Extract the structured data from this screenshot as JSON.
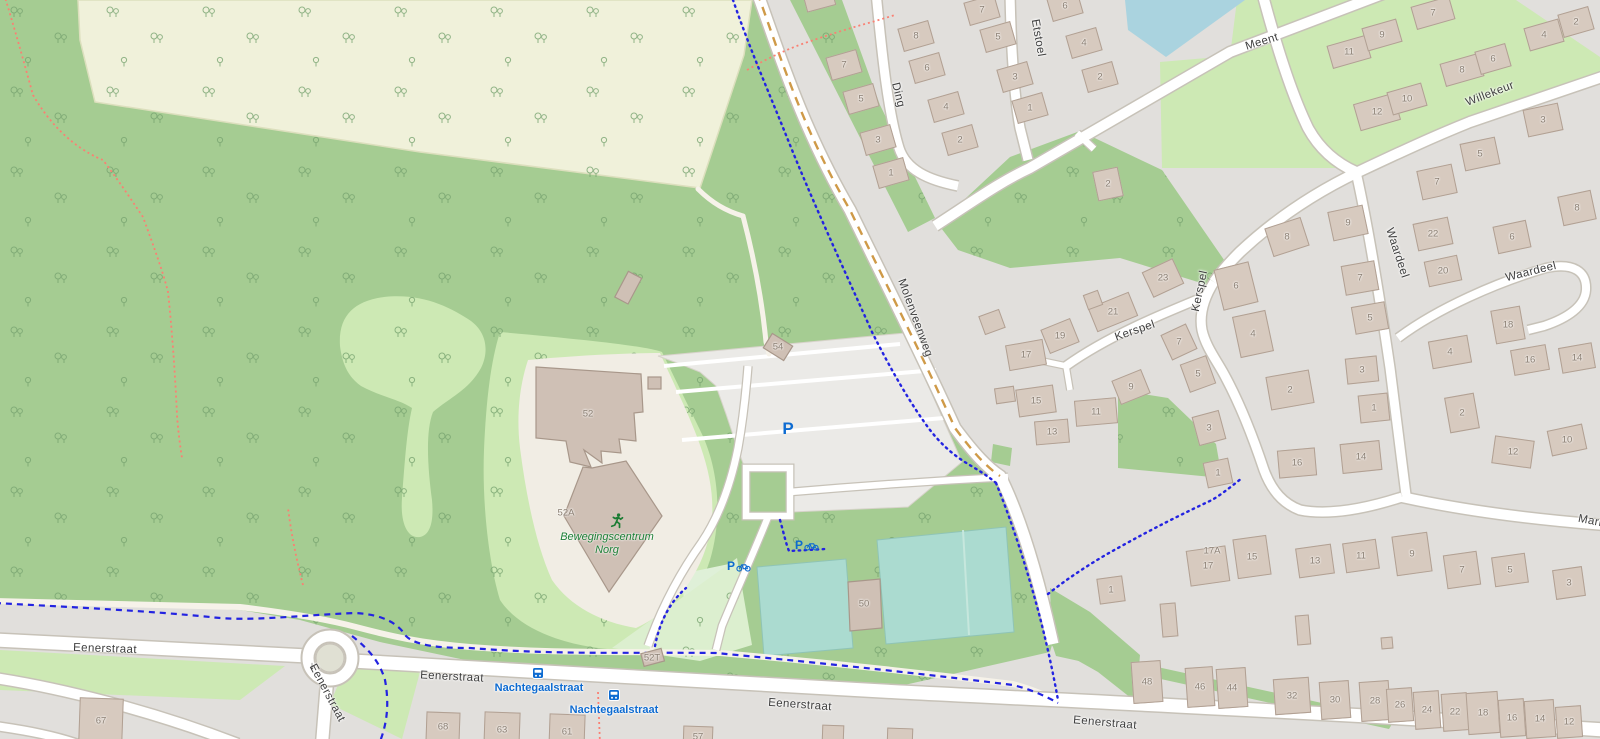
{
  "map": {
    "colors": {
      "residential": "#e1dfdc",
      "forest": "#a5cc92",
      "grass": "#cde9b4",
      "farmland": "#f0f1da",
      "water": "#aad3df",
      "pitch": "#abdbd0",
      "parking": "#ebeae7",
      "building": "#d7cabf",
      "road_fill": "#ffffff",
      "road_casing": "#c7c2b8",
      "cycleway_blue": "#2323e1",
      "footpath_red": "#fa8073",
      "unpaved_dash": "#cf9a48",
      "transit_blue": "#0d6bd1",
      "poi_green": "#1e8038"
    },
    "streets": [
      {
        "text": "Eenerstraat",
        "x": 105,
        "y": 649,
        "rot": 2
      },
      {
        "text": "Eenerstraat",
        "x": 452,
        "y": 677,
        "rot": 3
      },
      {
        "text": "Eenerstraat",
        "x": 327,
        "y": 693,
        "rot": 62
      },
      {
        "text": "Eenerstraat",
        "x": 800,
        "y": 705,
        "rot": 4
      },
      {
        "text": "Eenerstraat",
        "x": 1105,
        "y": 723,
        "rot": 5
      },
      {
        "text": "Molenveenweg",
        "x": 915,
        "y": 318,
        "rot": 70
      },
      {
        "text": "Meent",
        "x": 1262,
        "y": 42,
        "rot": -17
      },
      {
        "text": "Willekeur",
        "x": 1490,
        "y": 94,
        "rot": -21
      },
      {
        "text": "Ding",
        "x": 898,
        "y": 95,
        "rot": 76
      },
      {
        "text": "Etstoel",
        "x": 1038,
        "y": 38,
        "rot": 80
      },
      {
        "text": "Kerspel",
        "x": 1135,
        "y": 331,
        "rot": -19
      },
      {
        "text": "Kerspel",
        "x": 1200,
        "y": 291,
        "rot": -78
      },
      {
        "text": "Waardeel",
        "x": 1397,
        "y": 253,
        "rot": 72
      },
      {
        "text": "Waardeel",
        "x": 1531,
        "y": 272,
        "rot": -14
      },
      {
        "text": "Mari",
        "x": 1590,
        "y": 521,
        "rot": 11
      }
    ],
    "poi": {
      "name_line1": "Bewegingscentrum",
      "name_line2": "Norg",
      "x": 607,
      "y": 531,
      "icon_x": 617,
      "icon_y": 521
    },
    "bus_stops": [
      {
        "name": "Nachtegaalstraat",
        "icon_x": 538,
        "icon_y": 673,
        "label_x": 539,
        "label_y": 688
      },
      {
        "name": "Nachtegaalstraat",
        "icon_x": 614,
        "icon_y": 695,
        "label_x": 614,
        "label_y": 710
      }
    ],
    "parking": [
      {
        "symbol": "P",
        "x": 788,
        "y": 429
      }
    ],
    "bike_parking": [
      {
        "symbol": "P",
        "x": 739,
        "y": 566
      },
      {
        "symbol": "P",
        "x": 807,
        "y": 545
      }
    ],
    "oneway": {
      "symbol": "↓",
      "x": 312,
      "y": 666
    },
    "houses": [
      {
        "t": "7",
        "x": 844,
        "y": 65
      },
      {
        "t": "5",
        "x": 861,
        "y": 99
      },
      {
        "t": "3",
        "x": 878,
        "y": 140
      },
      {
        "t": "1",
        "x": 891,
        "y": 173
      },
      {
        "t": "8",
        "x": 916,
        "y": 36
      },
      {
        "t": "6",
        "x": 927,
        "y": 68
      },
      {
        "t": "4",
        "x": 946,
        "y": 107
      },
      {
        "t": "2",
        "x": 960,
        "y": 140
      },
      {
        "t": "7",
        "x": 982,
        "y": 10
      },
      {
        "t": "5",
        "x": 998,
        "y": 37
      },
      {
        "t": "3",
        "x": 1015,
        "y": 77
      },
      {
        "t": "1",
        "x": 1030,
        "y": 108
      },
      {
        "t": "6",
        "x": 1065,
        "y": 6
      },
      {
        "t": "4",
        "x": 1084,
        "y": 43
      },
      {
        "t": "2",
        "x": 1100,
        "y": 77
      },
      {
        "t": "2",
        "x": 1108,
        "y": 184,
        "w": 26,
        "h": 30,
        "r": -12
      },
      {
        "t": "11",
        "x": 1349,
        "y": 52,
        "w": 40
      },
      {
        "t": "9",
        "x": 1382,
        "y": 35,
        "w": 36
      },
      {
        "t": "7",
        "x": 1433,
        "y": 13,
        "w": 40
      },
      {
        "t": "12",
        "x": 1377,
        "y": 112,
        "w": 42,
        "h": 28
      },
      {
        "t": "10",
        "x": 1407,
        "y": 99,
        "w": 36
      },
      {
        "t": "8",
        "x": 1462,
        "y": 70,
        "w": 40
      },
      {
        "t": "6",
        "x": 1493,
        "y": 59,
        "w": 32
      },
      {
        "t": "4",
        "x": 1544,
        "y": 35,
        "w": 36
      },
      {
        "t": "2",
        "x": 1576,
        "y": 22,
        "w": 32
      },
      {
        "t": "3",
        "x": 1543,
        "y": 120,
        "w": 36,
        "h": 28,
        "r": -12
      },
      {
        "t": "5",
        "x": 1480,
        "y": 154,
        "w": 36,
        "h": 28,
        "r": -12
      },
      {
        "t": "7",
        "x": 1437,
        "y": 182,
        "w": 36,
        "h": 30,
        "r": -12
      },
      {
        "t": "8",
        "x": 1577,
        "y": 208,
        "w": 34,
        "h": 30,
        "r": -12
      },
      {
        "t": "6",
        "x": 1512,
        "y": 237,
        "w": 34,
        "h": 28,
        "r": -12
      },
      {
        "t": "22",
        "x": 1433,
        "y": 234,
        "w": 36,
        "h": 28,
        "r": -12
      },
      {
        "t": "20",
        "x": 1443,
        "y": 271,
        "w": 34,
        "h": 26,
        "r": -12
      },
      {
        "t": "9",
        "x": 1348,
        "y": 223,
        "w": 36,
        "h": 30,
        "r": -12
      },
      {
        "t": "7",
        "x": 1360,
        "y": 278,
        "w": 34,
        "h": 30,
        "r": -10
      },
      {
        "t": "5",
        "x": 1370,
        "y": 318,
        "w": 34,
        "h": 28,
        "r": -10
      },
      {
        "t": "3",
        "x": 1362,
        "y": 370,
        "w": 32,
        "h": 26,
        "r": -6
      },
      {
        "t": "1",
        "x": 1374,
        "y": 408,
        "w": 30,
        "h": 28,
        "r": -6
      },
      {
        "t": "14",
        "x": 1361,
        "y": 457,
        "w": 40,
        "h": 30,
        "r": -6
      },
      {
        "t": "18",
        "x": 1508,
        "y": 325,
        "w": 30,
        "h": 34,
        "r": -10
      },
      {
        "t": "16",
        "x": 1530,
        "y": 360,
        "w": 36,
        "h": 26,
        "r": -10
      },
      {
        "t": "14",
        "x": 1577,
        "y": 358,
        "w": 34,
        "h": 26,
        "r": -10
      },
      {
        "t": "4",
        "x": 1450,
        "y": 352,
        "w": 40,
        "h": 28,
        "r": -10
      },
      {
        "t": "2",
        "x": 1462,
        "y": 413,
        "w": 30,
        "h": 36,
        "r": -10
      },
      {
        "t": "12",
        "x": 1513,
        "y": 452,
        "w": 40,
        "h": 28,
        "r": 8
      },
      {
        "t": "10",
        "x": 1567,
        "y": 440,
        "w": 36,
        "h": 26,
        "r": -12
      },
      {
        "t": "23",
        "x": 1163,
        "y": 278,
        "w": 34,
        "h": 28,
        "r": -25
      },
      {
        "t": "21",
        "x": 1113,
        "y": 312,
        "w": 44,
        "h": 26,
        "r": -22
      },
      {
        "t": "19",
        "x": 1060,
        "y": 336,
        "w": 32,
        "h": 26,
        "r": -22
      },
      {
        "t": "17",
        "x": 1026,
        "y": 355,
        "w": 38,
        "h": 26,
        "r": -10
      },
      {
        "t": "15",
        "x": 1036,
        "y": 401,
        "w": 38,
        "h": 28,
        "r": -8
      },
      {
        "t": "13",
        "x": 1052,
        "y": 432,
        "w": 34,
        "h": 24,
        "r": -5
      },
      {
        "t": "11",
        "x": 1096,
        "y": 412,
        "w": 42,
        "h": 26,
        "r": -5
      },
      {
        "t": "9",
        "x": 1131,
        "y": 387,
        "w": 32,
        "h": 26,
        "r": -22
      },
      {
        "t": "7",
        "x": 1179,
        "y": 342,
        "w": 28,
        "h": 28,
        "r": -25
      },
      {
        "t": "5",
        "x": 1198,
        "y": 374,
        "w": 28,
        "h": 30,
        "r": -20
      },
      {
        "t": "3",
        "x": 1209,
        "y": 428,
        "w": 28,
        "h": 30,
        "r": -15
      },
      {
        "t": "1",
        "x": 1218,
        "y": 473,
        "w": 26,
        "h": 26,
        "r": -12
      },
      {
        "t": "8",
        "x": 1287,
        "y": 237,
        "w": 38,
        "h": 30,
        "r": -18
      },
      {
        "t": "6",
        "x": 1236,
        "y": 286,
        "w": 36,
        "h": 42,
        "r": -14
      },
      {
        "t": "4",
        "x": 1253,
        "y": 334,
        "w": 34,
        "h": 42,
        "r": -12
      },
      {
        "t": "2",
        "x": 1290,
        "y": 390,
        "w": 44,
        "h": 34,
        "r": -10
      },
      {
        "t": "16",
        "x": 1297,
        "y": 463,
        "w": 38,
        "h": 28,
        "r": -5
      },
      {
        "t": "1",
        "x": 1111,
        "y": 590,
        "w": 26,
        "h": 26,
        "r": -8
      },
      {
        "t": "17A",
        "x": 1212,
        "y": 551,
        "box": false
      },
      {
        "t": "17",
        "x": 1208,
        "y": 566,
        "w": 40,
        "h": 36,
        "r": -8
      },
      {
        "t": "15",
        "x": 1252,
        "y": 557,
        "w": 34,
        "h": 40,
        "r": -8
      },
      {
        "t": "13",
        "x": 1315,
        "y": 561,
        "w": 36,
        "h": 30,
        "r": -8
      },
      {
        "t": "11",
        "x": 1361,
        "y": 556,
        "w": 34,
        "h": 30,
        "r": -8
      },
      {
        "t": "9",
        "x": 1412,
        "y": 554,
        "w": 36,
        "h": 40,
        "r": -8
      },
      {
        "t": "7",
        "x": 1462,
        "y": 570,
        "w": 34,
        "h": 34,
        "r": -8
      },
      {
        "t": "5",
        "x": 1510,
        "y": 570,
        "w": 34,
        "h": 30,
        "r": -8
      },
      {
        "t": "3",
        "x": 1569,
        "y": 583,
        "w": 30,
        "h": 30,
        "r": -8
      },
      {
        "t": "48",
        "x": 1147,
        "y": 682,
        "w": 30,
        "h": 42,
        "r": -4
      },
      {
        "t": "46",
        "x": 1200,
        "y": 687,
        "w": 28,
        "h": 40,
        "r": -4
      },
      {
        "t": "44",
        "x": 1232,
        "y": 688,
        "w": 30,
        "h": 40,
        "r": -4
      },
      {
        "t": "32",
        "x": 1292,
        "y": 696,
        "w": 36,
        "h": 36,
        "r": -4
      },
      {
        "t": "30",
        "x": 1335,
        "y": 700,
        "w": 30,
        "h": 38,
        "r": -4
      },
      {
        "t": "28",
        "x": 1375,
        "y": 701,
        "w": 30,
        "h": 40,
        "r": -4
      },
      {
        "t": "26",
        "x": 1400,
        "y": 705,
        "w": 26,
        "h": 34,
        "r": -4
      },
      {
        "t": "24",
        "x": 1427,
        "y": 710,
        "w": 26,
        "h": 38,
        "r": -4
      },
      {
        "t": "22",
        "x": 1455,
        "y": 712,
        "w": 26,
        "h": 38,
        "r": -4
      },
      {
        "t": "18",
        "x": 1483,
        "y": 713,
        "w": 32,
        "h": 42,
        "r": -4
      },
      {
        "t": "16",
        "x": 1512,
        "y": 718,
        "w": 26,
        "h": 38,
        "r": -4
      },
      {
        "t": "14",
        "x": 1540,
        "y": 719,
        "w": 30,
        "h": 38,
        "r": -4
      },
      {
        "t": "12",
        "x": 1569,
        "y": 722,
        "w": 26,
        "h": 32,
        "r": -4
      },
      {
        "t": "67",
        "x": 101,
        "y": 721,
        "w": 44,
        "h": 46,
        "r": 2
      },
      {
        "t": "68",
        "x": 443,
        "y": 727,
        "w": 34,
        "h": 30,
        "r": 2
      },
      {
        "t": "63",
        "x": 502,
        "y": 730,
        "w": 36,
        "h": 36,
        "r": 2
      },
      {
        "t": "61",
        "x": 567,
        "y": 732,
        "w": 36,
        "h": 36,
        "r": 2
      },
      {
        "t": "57",
        "x": 698,
        "y": 737,
        "w": 30,
        "h": 22,
        "r": 2
      },
      {
        "t": "",
        "x": 833,
        "y": 734,
        "w": 22,
        "h": 18,
        "r": 2
      },
      {
        "t": "",
        "x": 900,
        "y": 736,
        "w": 26,
        "h": 16,
        "r": 2
      },
      {
        "t": "",
        "x": 992,
        "y": 322,
        "w": 22,
        "h": 20,
        "r": -20
      },
      {
        "t": "",
        "x": 1093,
        "y": 300,
        "w": 16,
        "h": 16,
        "r": -20
      },
      {
        "t": "",
        "x": 1005,
        "y": 395,
        "w": 20,
        "h": 16,
        "r": -8
      },
      {
        "t": "",
        "x": 1169,
        "y": 620,
        "w": 16,
        "h": 34,
        "r": -5
      },
      {
        "t": "",
        "x": 1303,
        "y": 630,
        "w": 14,
        "h": 30,
        "r": -5
      },
      {
        "t": "",
        "x": 1387,
        "y": 643,
        "w": 12,
        "h": 12,
        "r": -5
      },
      {
        "t": "",
        "x": 820,
        "y": 2,
        "w": 30,
        "h": 14,
        "r": -15
      },
      {
        "t": "52",
        "x": 588,
        "y": 414,
        "box": false
      },
      {
        "t": "52A",
        "x": 566,
        "y": 513,
        "box": false
      },
      {
        "t": "54",
        "x": 778,
        "y": 347,
        "box": false
      },
      {
        "t": "50",
        "x": 864,
        "y": 604,
        "box": false
      },
      {
        "t": "52T",
        "x": 652,
        "y": 658,
        "box": false
      }
    ]
  }
}
